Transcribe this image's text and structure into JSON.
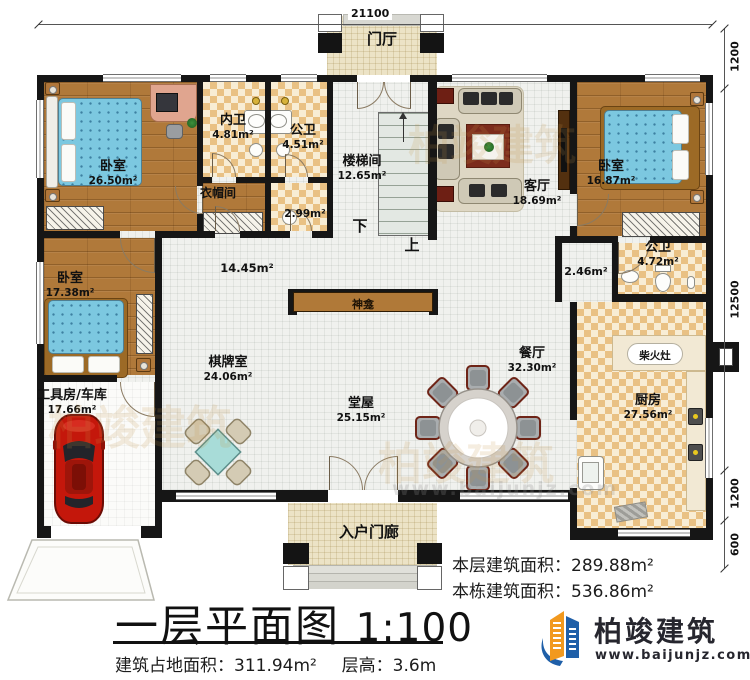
{
  "dimensions": {
    "top": "21100",
    "right": [
      "1200",
      "12500",
      "1200",
      "600"
    ]
  },
  "rooms": {
    "foyer": {
      "name": "门厅"
    },
    "bedroom1": {
      "name": "卧室",
      "area": "26.50m²"
    },
    "inner_bath": {
      "name": "内卫",
      "area": "4.81m²"
    },
    "public_bath_top": {
      "name": "公卫",
      "area": "4.51m²"
    },
    "cloakroom": {
      "name": "衣帽间"
    },
    "washroom": {
      "area": "2.99m²"
    },
    "stairwell": {
      "name": "楼梯间",
      "area": "12.65m²"
    },
    "living": {
      "name": "客厅",
      "area": "18.69m²"
    },
    "bedroom2": {
      "name": "卧室",
      "area": "16.87m²"
    },
    "corridor": {
      "area": "2.46m²"
    },
    "public_bath_right": {
      "name": "公卫",
      "area": "4.72m²"
    },
    "hallway": {
      "area": "14.45m²"
    },
    "chess_room": {
      "name": "棋牌室",
      "area": "24.06m²"
    },
    "main_hall": {
      "name": "堂屋",
      "area": "25.15m²"
    },
    "dining": {
      "name": "餐厅",
      "area": "32.30m²"
    },
    "kitchen": {
      "name": "厨房",
      "area": "27.56m²"
    },
    "bedroom3": {
      "name": "卧室",
      "area": "17.38m²"
    },
    "garage": {
      "name": "工具房/车库",
      "area": "17.66m²"
    },
    "porch": {
      "name": "入户门廊"
    }
  },
  "annotations": {
    "shrine": "神龛",
    "wood_stove": "柴火灶",
    "stair_up": "上",
    "stair_down": "下"
  },
  "title_block": {
    "plan_title": "一层平面图",
    "scale": "1:100",
    "footprint_label": "建筑占地面积：",
    "footprint_value": "311.94m²",
    "storey_label": "层高：",
    "storey_value": "3.6m",
    "floor_area_label": "本层建筑面积：",
    "floor_area_value": "289.88m²",
    "building_area_label": "本栋建筑面积：",
    "building_area_value": "536.86m²"
  },
  "brand": {
    "name": "柏竣建筑",
    "website": "www.baijunjz.com"
  },
  "colors": {
    "wall": "#161616",
    "wood_floor": "#b0793a",
    "tile": "#e9c184",
    "brand_blue": "#1f5fa8",
    "brand_orange": "#f2991e"
  }
}
